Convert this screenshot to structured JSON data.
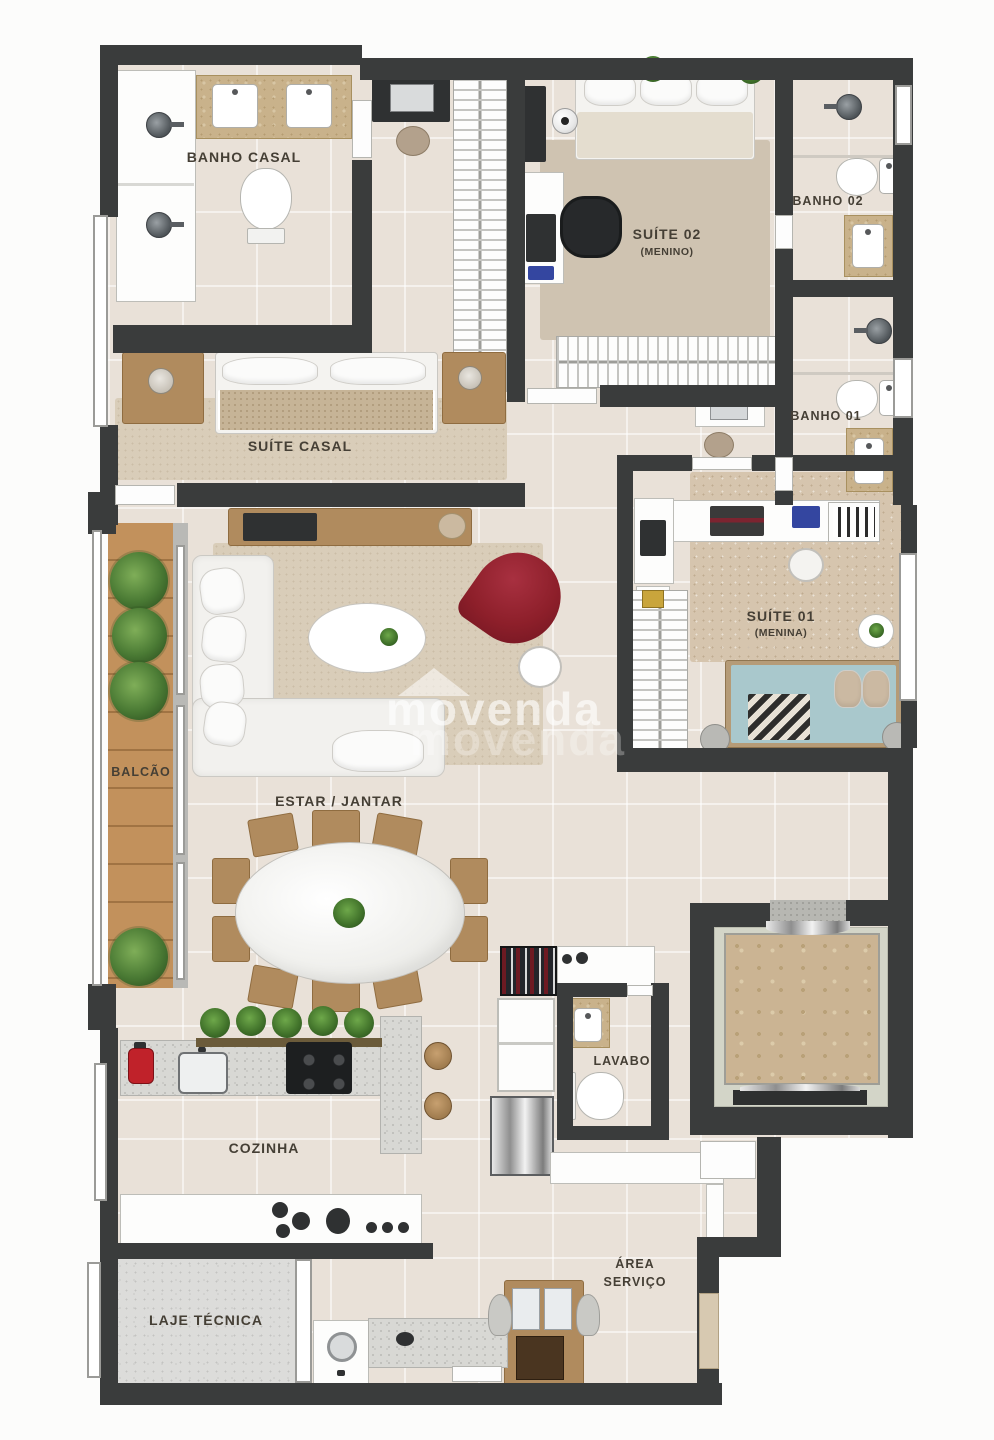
{
  "watermark": {
    "text": "movenda"
  },
  "labels": {
    "banho_casal": "BANHO CASAL",
    "suite_casal": "SUÍTE CASAL",
    "suite02": "SUÍTE 02",
    "suite02_sub": "(MENINO)",
    "banho02": "BANHO 02",
    "banho01": "BANHO 01",
    "suite01": "SUÍTE 01",
    "suite01_sub": "(MENINA)",
    "balcao": "BALCÃO",
    "estar_jantar": "ESTAR / JANTAR",
    "lavabo": "LAVABO",
    "cozinha": "COZINHA",
    "area_servico_line1": "ÁREA",
    "area_servico_line2": "SERVIÇO",
    "laje_tecnica": "LAJE TÉCNICA"
  },
  "colors": {
    "wall": "#3a3c3c",
    "floor": "#e9e1d8",
    "wood_deck": "#c2915c",
    "counter_marble": "#c9b28b",
    "accent_red_chair": "#8d1f2a",
    "bed_blue": "#a9c8cc",
    "elevator_marble": "#cbb493"
  }
}
